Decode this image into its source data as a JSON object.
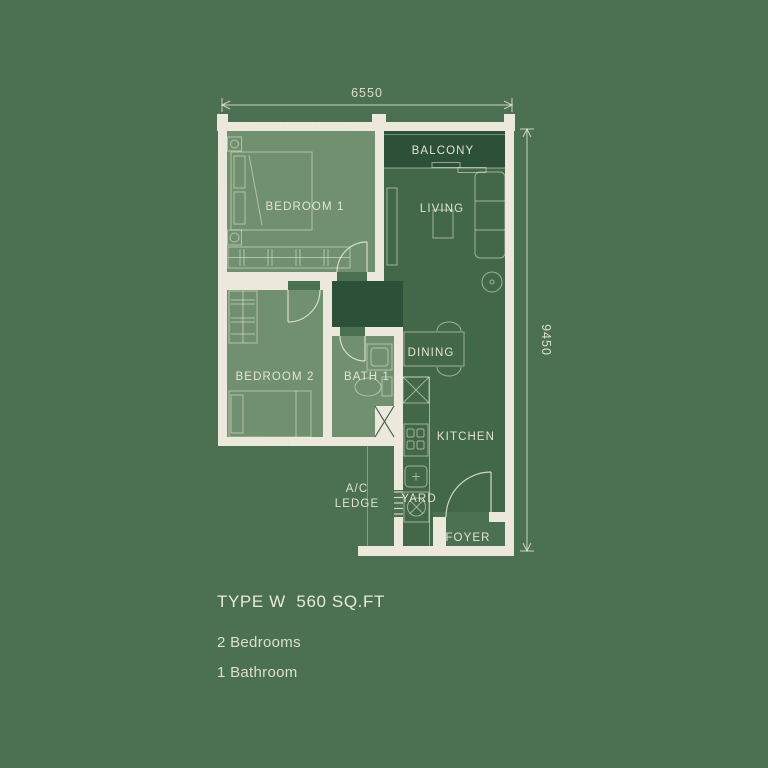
{
  "colors": {
    "bg": "#4C7052",
    "wall": "#ECE9DC",
    "room-light": "#70906F",
    "room-dark": "#436849",
    "room-darker": "#2D5138",
    "ink": "#EAE8DB"
  },
  "plan": {
    "width_dim": "6550",
    "height_dim": "9450",
    "rooms": {
      "balcony": "BALCONY",
      "living": "LIVING",
      "bedroom1": "BEDROOM 1",
      "bedroom2": "BEDROOM 2",
      "bath1": "BATH 1",
      "dining": "DINING",
      "kitchen": "KITCHEN",
      "ac_line1": "A/C",
      "ac_line2": "LEDGE",
      "yard": "YARD",
      "foyer": "FOYER"
    }
  },
  "details": {
    "title": "TYPE W  560 SQ.FT",
    "bedrooms": "2 Bedrooms",
    "bathrooms": "1 Bathroom"
  }
}
